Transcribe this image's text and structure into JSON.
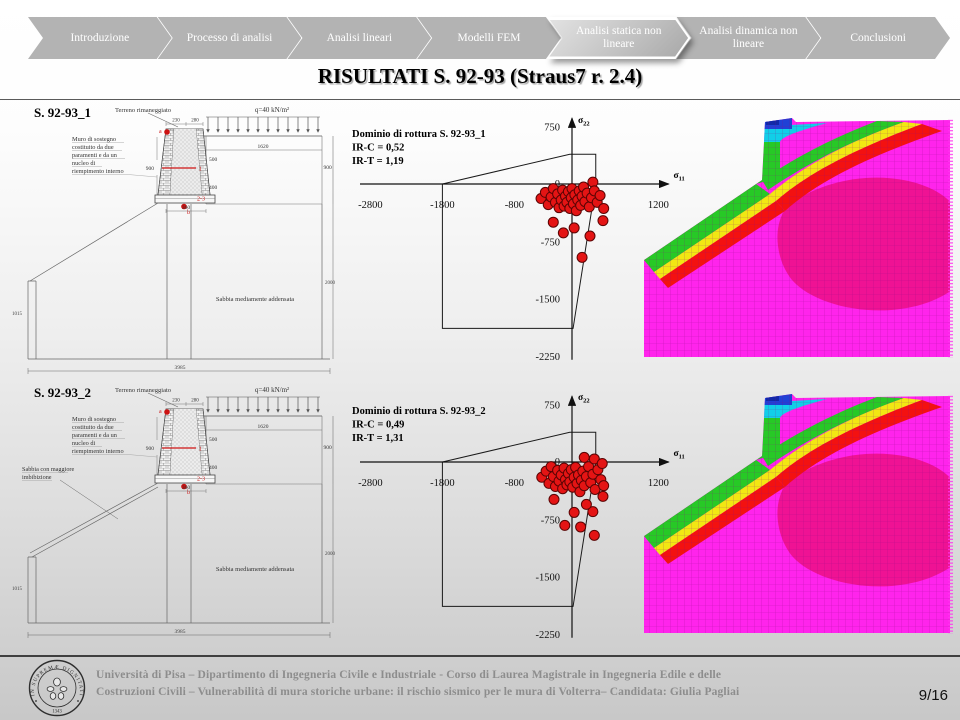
{
  "nav": {
    "items": [
      {
        "label": "Introduzione",
        "active": false
      },
      {
        "label": "Processo di analisi",
        "active": false
      },
      {
        "label": "Analisi lineari",
        "active": false
      },
      {
        "label": "Modelli FEM",
        "active": false
      },
      {
        "label": "Analisi statica non lineare",
        "active": true
      },
      {
        "label": "Analisi dinamica non lineare",
        "active": false
      },
      {
        "label": "Conclusioni",
        "active": false
      }
    ]
  },
  "title": "RISULTATI  S. 92-93 (Straus7 r. 2.4)",
  "drawing_common": {
    "terrain_label": "Terreno rimaneggiato",
    "load_label": "q=40 kN/m²",
    "wall_note_lines": [
      "Muro di sostegno",
      "costituito da due",
      "paramenti e da un",
      "nucleo di",
      "riempimento interno"
    ],
    "soil_label": "Sabbia mediamente addensata",
    "dims": {
      "top_left": "230",
      "top_right": "280",
      "embankment_width": "1620",
      "upper_height": "500",
      "lower_height": "400",
      "base_width": "360",
      "wall_height": "900",
      "right_height": "900",
      "left_depth": "1015",
      "right_depth": "2000",
      "total_width": "3985"
    },
    "markers": {
      "point_a": "a",
      "point_b": "b",
      "section_1": "1",
      "section_23": "2-3"
    }
  },
  "rows": [
    {
      "drawing": {
        "name": "S. 92-93_1"
      }
    },
    {
      "drawing": {
        "name": "S. 92-93_2",
        "extra_label_lines": [
          "Sabbia con maggiore",
          "imbibizione"
        ]
      }
    }
  ],
  "chart_data": [
    {
      "type": "scatter",
      "title": "Dominio di rottura S. 92-93_1",
      "ir_c": "IR-C = 0,52",
      "ir_t": "IR-T = 1,19",
      "xlabel": {
        "base": "σ",
        "sub": "11"
      },
      "ylabel": {
        "base": "σ",
        "sub": "22"
      },
      "x_ticks": [
        -2800,
        -1800,
        -800,
        1200
      ],
      "y_ticks": [
        750,
        0,
        -750,
        -1500,
        -2250
      ],
      "xlim": [
        -3000,
        1400
      ],
      "ylim": [
        -2350,
        900
      ],
      "grid": false,
      "domain_polygon": [
        [
          -1800,
          0
        ],
        [
          -30,
          390
        ],
        [
          330,
          390
        ],
        [
          330,
          0
        ],
        [
          15,
          -1890
        ],
        [
          -1800,
          -1890
        ]
      ],
      "points": [
        [
          -430,
          -190
        ],
        [
          -370,
          -110
        ],
        [
          -330,
          -270
        ],
        [
          -290,
          -170
        ],
        [
          -260,
          -60
        ],
        [
          -230,
          -240
        ],
        [
          -200,
          -130
        ],
        [
          -180,
          -310
        ],
        [
          -150,
          -210
        ],
        [
          -130,
          -80
        ],
        [
          -110,
          -290
        ],
        [
          -90,
          -160
        ],
        [
          -70,
          -240
        ],
        [
          -50,
          -100
        ],
        [
          -30,
          -320
        ],
        [
          -10,
          -180
        ],
        [
          0,
          -60
        ],
        [
          20,
          -260
        ],
        [
          40,
          -140
        ],
        [
          60,
          -350
        ],
        [
          80,
          -210
        ],
        [
          100,
          -90
        ],
        [
          120,
          -280
        ],
        [
          140,
          -160
        ],
        [
          160,
          -40
        ],
        [
          180,
          -230
        ],
        [
          210,
          -120
        ],
        [
          240,
          -300
        ],
        [
          270,
          -180
        ],
        [
          290,
          25
        ],
        [
          310,
          -90
        ],
        [
          350,
          -240
        ],
        [
          390,
          -150
        ],
        [
          440,
          -320
        ],
        [
          -260,
          -500
        ],
        [
          -120,
          -640
        ],
        [
          30,
          -575
        ],
        [
          140,
          -960
        ],
        [
          250,
          -680
        ],
        [
          430,
          -480
        ]
      ]
    },
    {
      "type": "scatter",
      "title": "Dominio di rottura S. 92-93_2",
      "ir_c": "IR-C = 0,49",
      "ir_t": "IR-T = 1,31",
      "xlabel": {
        "base": "σ",
        "sub": "11"
      },
      "ylabel": {
        "base": "σ",
        "sub": "22"
      },
      "x_ticks": [
        -2800,
        -1800,
        -800,
        1200
      ],
      "y_ticks": [
        750,
        0,
        -750,
        -1500,
        -2250
      ],
      "xlim": [
        -3000,
        1400
      ],
      "ylim": [
        -2350,
        900
      ],
      "grid": false,
      "domain_polygon": [
        [
          -1800,
          0
        ],
        [
          -30,
          390
        ],
        [
          330,
          390
        ],
        [
          330,
          0
        ],
        [
          15,
          -1890
        ],
        [
          -1800,
          -1890
        ]
      ],
      "points": [
        [
          -420,
          -200
        ],
        [
          -360,
          -120
        ],
        [
          -320,
          -280
        ],
        [
          -290,
          -60
        ],
        [
          -260,
          -190
        ],
        [
          -230,
          -320
        ],
        [
          -200,
          -110
        ],
        [
          -180,
          -250
        ],
        [
          -150,
          -170
        ],
        [
          -130,
          -350
        ],
        [
          -110,
          -80
        ],
        [
          -90,
          -230
        ],
        [
          -70,
          -300
        ],
        [
          -50,
          -150
        ],
        [
          -30,
          -260
        ],
        [
          -10,
          -100
        ],
        [
          10,
          -330
        ],
        [
          30,
          -200
        ],
        [
          50,
          -70
        ],
        [
          70,
          -280
        ],
        [
          90,
          -170
        ],
        [
          110,
          -390
        ],
        [
          130,
          -240
        ],
        [
          150,
          -120
        ],
        [
          170,
          -310
        ],
        [
          200,
          -190
        ],
        [
          230,
          -60
        ],
        [
          260,
          -270
        ],
        [
          290,
          -160
        ],
        [
          320,
          -360
        ],
        [
          360,
          -100
        ],
        [
          400,
          -230
        ],
        [
          440,
          -310
        ],
        [
          170,
          60
        ],
        [
          310,
          40
        ],
        [
          420,
          -20
        ],
        [
          -250,
          -490
        ],
        [
          -100,
          -830
        ],
        [
          30,
          -660
        ],
        [
          120,
          -850
        ],
        [
          310,
          -960
        ],
        [
          290,
          -650
        ],
        [
          430,
          -450
        ],
        [
          200,
          -555
        ]
      ]
    }
  ],
  "footer": {
    "line1": "Università di Pisa – Dipartimento di Ingegneria Civile e Industriale - Corso di Laurea Magistrale in Ingegneria Edile e delle",
    "line2": "Costruzioni Civili – Vulnerabilità di mura storiche urbane: il rischio sismico per le mura di Volterra– Candidata: Giulia Pagliai",
    "seal_text": "IN SUPREMÆ DIGNITATIS",
    "seal_year": "1343",
    "page": "9/16"
  }
}
